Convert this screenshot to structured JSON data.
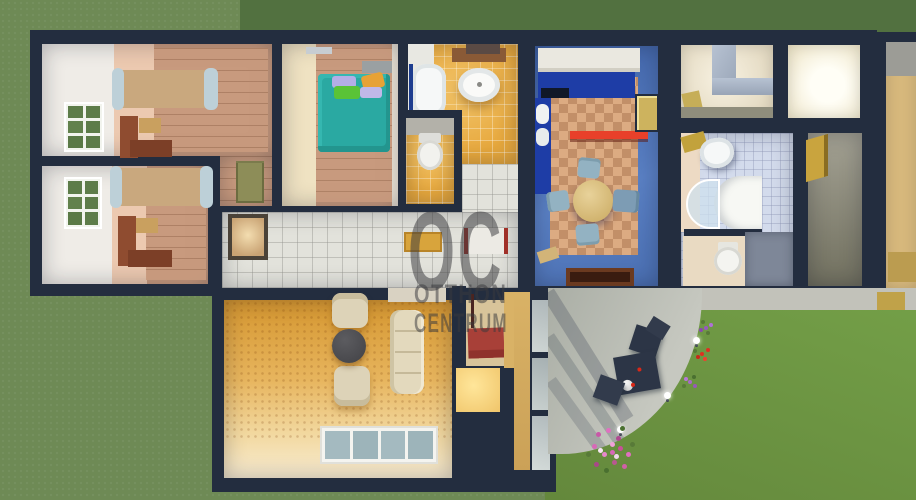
{
  "watermark": {
    "line1": "OC",
    "line2": "OTTHON",
    "line3": "CENTRUM"
  },
  "palette": {
    "wall_navy": "#232d3f",
    "grass": "#6e8a55",
    "grass_dark_band": "#527140",
    "garden_green": "#6f9a46",
    "terrace_grey": "#b9bcb3",
    "bedroom_floor_tile": "#c89a7e",
    "bed_tan": "#c9a87e",
    "bed_teal": "#2aa9a2",
    "desk_brown": "#8f4c30",
    "window_shutter_green": "#5d7c49",
    "kitchen_wall_blue": "#4f74b8",
    "kitchen_counter_blue": "#1e3da6",
    "kitchen_shelf_red": "#e8402a",
    "kitchen_floor_check_a": "#dcab82",
    "kitchen_floor_check_b": "#c28f68",
    "bath_tile_orange": "#e7a83d",
    "bath_tile_blue": "#d3dbec",
    "hall_tile_white": "#e2e2db",
    "living_floor_orange": "#e0a145",
    "sofa_cream": "#e3d9bd",
    "red_mat": "#a84038",
    "watermark_grey": "rgba(58,58,62,0.52)"
  }
}
